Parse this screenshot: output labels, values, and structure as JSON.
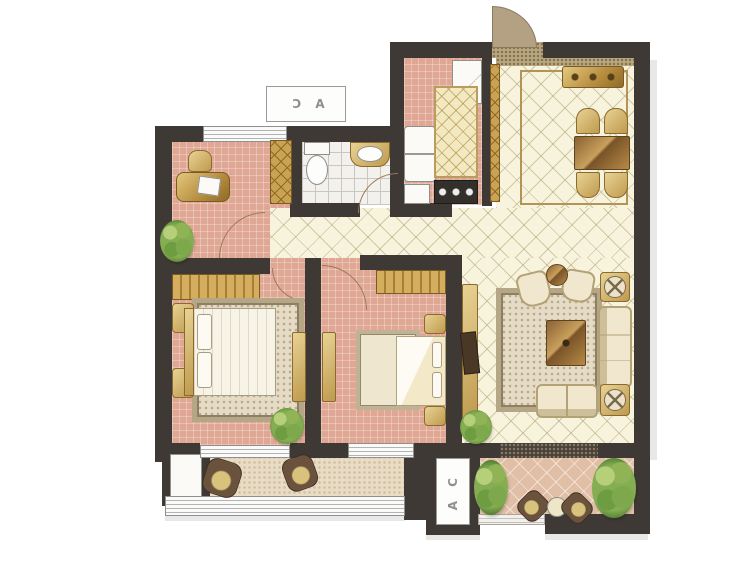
{
  "labels": {
    "ac_top": "A C",
    "ac_bottom": "A C"
  },
  "palette": {
    "wall": "#3f3936",
    "floor_pink": "#dfa794",
    "floor_cream": "#f8f3dc",
    "lattice_line": "#a0915f",
    "bathroom_tile": "#f3f1ed",
    "furniture_gold": "#b68c3e",
    "rug_beige": "#e6dcc6",
    "balcony_tile": "#e0bfa6",
    "plant_green": "#6d9c41",
    "door_arc": "#9b7b5a",
    "ac_text_gray": "#8f8f8d",
    "window_line": "#b3b3b0"
  }
}
